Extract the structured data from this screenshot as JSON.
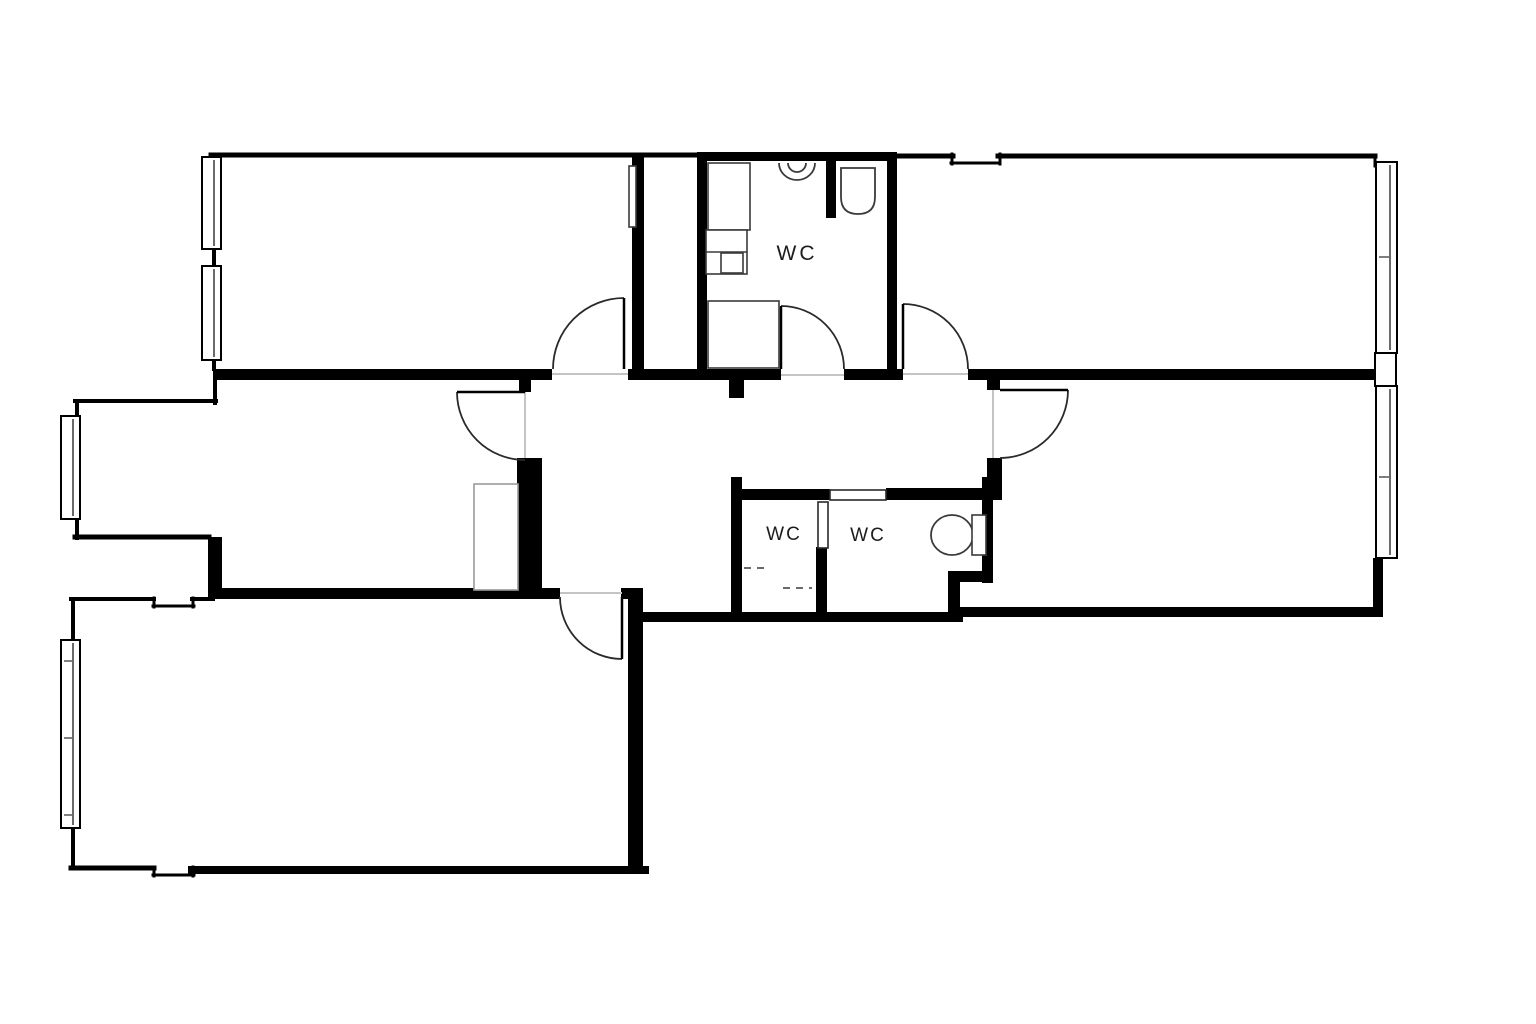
{
  "canvas": {
    "width": 1536,
    "height": 1024,
    "background": "#ffffff",
    "ink": "#000000",
    "line_color": "#2a2a2a",
    "fixture_color": "#3a3a3a",
    "threshold_color": "#c4c4c4",
    "cabinet_color": "#9a9a9a"
  },
  "labels": [
    {
      "name": "room-label-wc-bathroom",
      "text": "WC",
      "x": 797,
      "y": 260,
      "font_size": 21,
      "letter_spacing": 3
    },
    {
      "name": "room-label-wc-left",
      "text": "WC",
      "x": 784,
      "y": 540,
      "font_size": 19,
      "letter_spacing": 2
    },
    {
      "name": "room-label-wc-right",
      "text": "WC",
      "x": 868,
      "y": 541,
      "font_size": 19,
      "letter_spacing": 2
    }
  ],
  "walls_thick": [
    {
      "name": "wall-band-1",
      "rect": [
        213,
        369,
        339,
        11
      ]
    },
    {
      "name": "wall-band-2",
      "rect": [
        628,
        369,
        153,
        11
      ]
    },
    {
      "name": "wall-band-3",
      "rect": [
        844,
        369,
        59,
        11
      ]
    },
    {
      "name": "wall-band-4",
      "rect": [
        968,
        369,
        406,
        11
      ]
    },
    {
      "name": "wall-bathroom-left",
      "rect": [
        697,
        154,
        10,
        226
      ]
    },
    {
      "name": "wall-bathroom-right",
      "rect": [
        887,
        154,
        10,
        226
      ]
    },
    {
      "name": "wall-bathroom-top",
      "rect": [
        697,
        152,
        200,
        9
      ]
    },
    {
      "name": "wall-bathroom-partition",
      "rect": [
        826,
        154,
        10,
        64
      ]
    },
    {
      "name": "wall-room-a-right",
      "rect": [
        632,
        156,
        12,
        224
      ]
    },
    {
      "name": "wall-hall-left-jamb",
      "rect": [
        519,
        379,
        12,
        13
      ]
    },
    {
      "name": "wall-hall-left-block",
      "rect": [
        517,
        458,
        25,
        132
      ]
    },
    {
      "name": "wall-hall-bottom",
      "rect": [
        213,
        588,
        347,
        11
      ]
    },
    {
      "name": "wall-hall-bottom-right",
      "rect": [
        621,
        588,
        22,
        11
      ]
    },
    {
      "name": "wall-bottom-left-right",
      "rect": [
        628,
        588,
        15,
        285
      ]
    },
    {
      "name": "wall-hall-stub",
      "rect": [
        729,
        379,
        15,
        19
      ]
    },
    {
      "name": "wall-wc-left-wall",
      "rect": [
        731,
        477,
        11,
        141
      ]
    },
    {
      "name": "wall-wc-top-left",
      "rect": [
        731,
        489,
        99,
        11
      ]
    },
    {
      "name": "wall-wc-top-right",
      "rect": [
        886,
        488,
        116,
        12
      ]
    },
    {
      "name": "wall-wc-mid",
      "rect": [
        816,
        547,
        11,
        71
      ]
    },
    {
      "name": "wall-wc-right-wall",
      "rect": [
        982,
        477,
        11,
        106
      ]
    },
    {
      "name": "wall-wc-corner-h",
      "rect": [
        948,
        571,
        45,
        11
      ]
    },
    {
      "name": "wall-wc-corner-v",
      "rect": [
        948,
        571,
        12,
        47
      ]
    },
    {
      "name": "wall-right-room-jamb",
      "rect": [
        987,
        377,
        13,
        13
      ]
    },
    {
      "name": "wall-right-room-lower",
      "rect": [
        987,
        458,
        15,
        42
      ]
    },
    {
      "name": "wall-right-room-corner",
      "rect": [
        1373,
        558,
        10,
        54
      ]
    },
    {
      "name": "wall-exterior-bottom-mid",
      "rect": [
        643,
        612,
        320,
        10
      ]
    },
    {
      "name": "wall-exterior-bottom-right",
      "rect": [
        958,
        607,
        425,
        10
      ]
    },
    {
      "name": "wall-mid-left-step",
      "rect": [
        208,
        537,
        14,
        61
      ]
    }
  ],
  "walls_thin": [
    {
      "name": "wall-room-a-top",
      "line": [
        211,
        155,
        697,
        155
      ],
      "w": 5
    },
    {
      "name": "wall-room-a-left",
      "line": [
        214,
        155,
        214,
        369
      ],
      "w": 4
    },
    {
      "name": "wall-top-right-top-1",
      "line": [
        897,
        156,
        953,
        156
      ],
      "w": 5
    },
    {
      "name": "wall-top-right-notch-a",
      "line": [
        952,
        154,
        952,
        164
      ],
      "w": 3
    },
    {
      "name": "wall-top-right-notch-b",
      "line": [
        951,
        163,
        1000,
        163
      ],
      "w": 3
    },
    {
      "name": "wall-top-right-notch-c",
      "line": [
        1000,
        154,
        1000,
        164
      ],
      "w": 3
    },
    {
      "name": "wall-top-right-top-2",
      "line": [
        998,
        156,
        1375,
        156
      ],
      "w": 5
    },
    {
      "name": "wall-top-right-right",
      "line": [
        1375,
        155,
        1375,
        166
      ],
      "w": 3
    },
    {
      "name": "wall-mid-left-vert",
      "line": [
        215,
        377,
        215,
        403
      ],
      "w": 4
    },
    {
      "name": "wall-mid-left-top",
      "line": [
        75,
        401,
        216,
        401
      ],
      "w": 4
    },
    {
      "name": "wall-mid-left-left-upper",
      "line": [
        77,
        401,
        77,
        418
      ],
      "w": 4
    },
    {
      "name": "wall-mid-left-left-lower",
      "line": [
        77,
        518,
        77,
        538
      ],
      "w": 4
    },
    {
      "name": "wall-mid-left-bottom",
      "line": [
        75,
        537,
        209,
        537
      ],
      "w": 5
    },
    {
      "name": "wall-bottom-left-top-1",
      "line": [
        71,
        599,
        154,
        599
      ],
      "w": 4
    },
    {
      "name": "wall-bl-notch-top-a",
      "line": [
        154,
        598,
        154,
        607
      ],
      "w": 3
    },
    {
      "name": "wall-bl-notch-top-b",
      "line": [
        153,
        606,
        194,
        606
      ],
      "w": 3
    },
    {
      "name": "wall-bl-notch-top-c",
      "line": [
        193,
        598,
        193,
        607
      ],
      "w": 3
    },
    {
      "name": "wall-bottom-left-top-2",
      "line": [
        192,
        599,
        213,
        599
      ],
      "w": 4
    },
    {
      "name": "wall-bottom-left-left-upper",
      "line": [
        73,
        599,
        73,
        641
      ],
      "w": 4
    },
    {
      "name": "wall-bottom-left-left-lower",
      "line": [
        73,
        826,
        73,
        868
      ],
      "w": 4
    },
    {
      "name": "wall-bottom-left-bottom-1",
      "line": [
        71,
        868,
        154,
        868
      ],
      "w": 5
    },
    {
      "name": "wall-bl-notch-bot-a",
      "line": [
        154,
        867,
        154,
        876
      ],
      "w": 3
    },
    {
      "name": "wall-bl-notch-bot-b",
      "line": [
        153,
        875,
        194,
        875
      ],
      "w": 3
    },
    {
      "name": "wall-bl-notch-bot-c",
      "line": [
        193,
        867,
        193,
        876
      ],
      "w": 3
    },
    {
      "name": "wall-bottom-left-bottom-2",
      "line": [
        192,
        870,
        645,
        870
      ],
      "w": 8
    }
  ],
  "windows": [
    {
      "name": "window-room-a-1",
      "rect": [
        202,
        157,
        19,
        92
      ],
      "ticks": []
    },
    {
      "name": "window-room-a-2",
      "rect": [
        202,
        266,
        19,
        94
      ],
      "ticks": []
    },
    {
      "name": "window-middle-left",
      "rect": [
        61,
        416,
        19,
        103
      ],
      "ticks": []
    },
    {
      "name": "window-bottom-left",
      "rect": [
        61,
        640,
        19,
        188
      ],
      "ticks": [
        661,
        738,
        815
      ]
    },
    {
      "name": "window-top-right",
      "rect": [
        1376,
        162,
        21,
        191
      ],
      "ticks": [
        257
      ]
    },
    {
      "name": "window-right-room",
      "rect": [
        1376,
        386,
        21,
        172
      ],
      "ticks": [
        477
      ]
    },
    {
      "name": "window-spacer-right",
      "rect": [
        1375,
        353,
        21,
        33
      ],
      "spacer": true,
      "ticks": []
    }
  ],
  "doors": [
    {
      "name": "door-room-a",
      "leaf": [
        624,
        369,
        624,
        298
      ],
      "arc": "M 553 369 A 71 71 0 0 1 624 298"
    },
    {
      "name": "door-bathroom",
      "leaf": [
        781,
        369,
        781,
        306
      ],
      "arc": "M 781 306 A 63 63 0 0 1 844 369"
    },
    {
      "name": "door-top-right-room",
      "leaf": [
        903,
        369,
        903,
        304
      ],
      "arc": "M 903 304 A 65 65 0 0 1 968 369"
    },
    {
      "name": "door-middle-left-room",
      "leaf": [
        525,
        392,
        457,
        392
      ],
      "arc": "M 457 392 A 68 68 0 0 0 525 460"
    },
    {
      "name": "door-right-room",
      "leaf": [
        1000,
        390,
        1068,
        390
      ],
      "arc": "M 1068 390 A 68 68 0 0 1 1000 458"
    },
    {
      "name": "door-bottom-left-room",
      "leaf": [
        622,
        597,
        622,
        659
      ],
      "arc": "M 560 597 A 62 62 0 0 0 622 659"
    }
  ],
  "door_leaf_rects": [
    {
      "name": "door-wc-right-leaf",
      "rect": [
        830,
        490,
        56,
        10
      ]
    },
    {
      "name": "door-wc-inner-leaf",
      "rect": [
        818,
        502,
        10,
        46
      ]
    }
  ],
  "thresholds": [
    {
      "name": "threshold-room-a",
      "line": [
        552,
        374,
        628,
        374
      ]
    },
    {
      "name": "threshold-bathroom",
      "line": [
        781,
        375,
        844,
        375
      ]
    },
    {
      "name": "threshold-top-right",
      "line": [
        903,
        374,
        968,
        374
      ]
    },
    {
      "name": "threshold-middle-left",
      "line": [
        525,
        392,
        525,
        458
      ]
    },
    {
      "name": "threshold-right-room",
      "line": [
        993,
        390,
        993,
        458
      ]
    },
    {
      "name": "threshold-bottom-left",
      "line": [
        560,
        593,
        622,
        593
      ]
    }
  ],
  "fixtures": [
    {
      "name": "sink-icon",
      "type": "path",
      "d": "M 779 163 A 18 17 0 0 0 815 163 M 788 163 A 9 9 0 0 0 806 163"
    },
    {
      "name": "toilet-bathroom-icon",
      "type": "path",
      "d": "M 841 168 L 875 168 L 875 197 Q 875 214 858 214 Q 841 214 841 197 Z"
    },
    {
      "name": "washer-icon",
      "type": "rect",
      "rect": [
        708,
        163,
        42,
        67
      ]
    },
    {
      "name": "counter-icon",
      "type": "rect",
      "rect": [
        706,
        230,
        41,
        44
      ]
    },
    {
      "name": "counter-divider",
      "type": "line",
      "line": [
        706,
        252,
        747,
        252
      ]
    },
    {
      "name": "counter-small-box",
      "type": "rect",
      "rect": [
        721,
        253,
        22,
        20
      ]
    },
    {
      "name": "shower-tray-icon",
      "type": "rect",
      "rect": [
        708,
        301,
        71,
        67
      ]
    },
    {
      "name": "toilet-wc-bowl-icon",
      "type": "ellipse",
      "cx": 952,
      "cy": 535,
      "rx": 21,
      "ry": 20
    },
    {
      "name": "toilet-wc-tank-icon",
      "type": "rect",
      "rect": [
        972,
        515,
        14,
        40
      ]
    },
    {
      "name": "cabinet-icon",
      "type": "rect",
      "rect": [
        474,
        484,
        44,
        106
      ],
      "cabinet": true
    },
    {
      "name": "duct-icon",
      "type": "rect",
      "rect": [
        629,
        166,
        7,
        61
      ]
    },
    {
      "name": "dashed-mark-1",
      "type": "line",
      "line": [
        744,
        568,
        768,
        568
      ],
      "dashed": true
    },
    {
      "name": "dashed-mark-2",
      "type": "line",
      "line": [
        783,
        588,
        812,
        588
      ],
      "dashed": true
    }
  ]
}
